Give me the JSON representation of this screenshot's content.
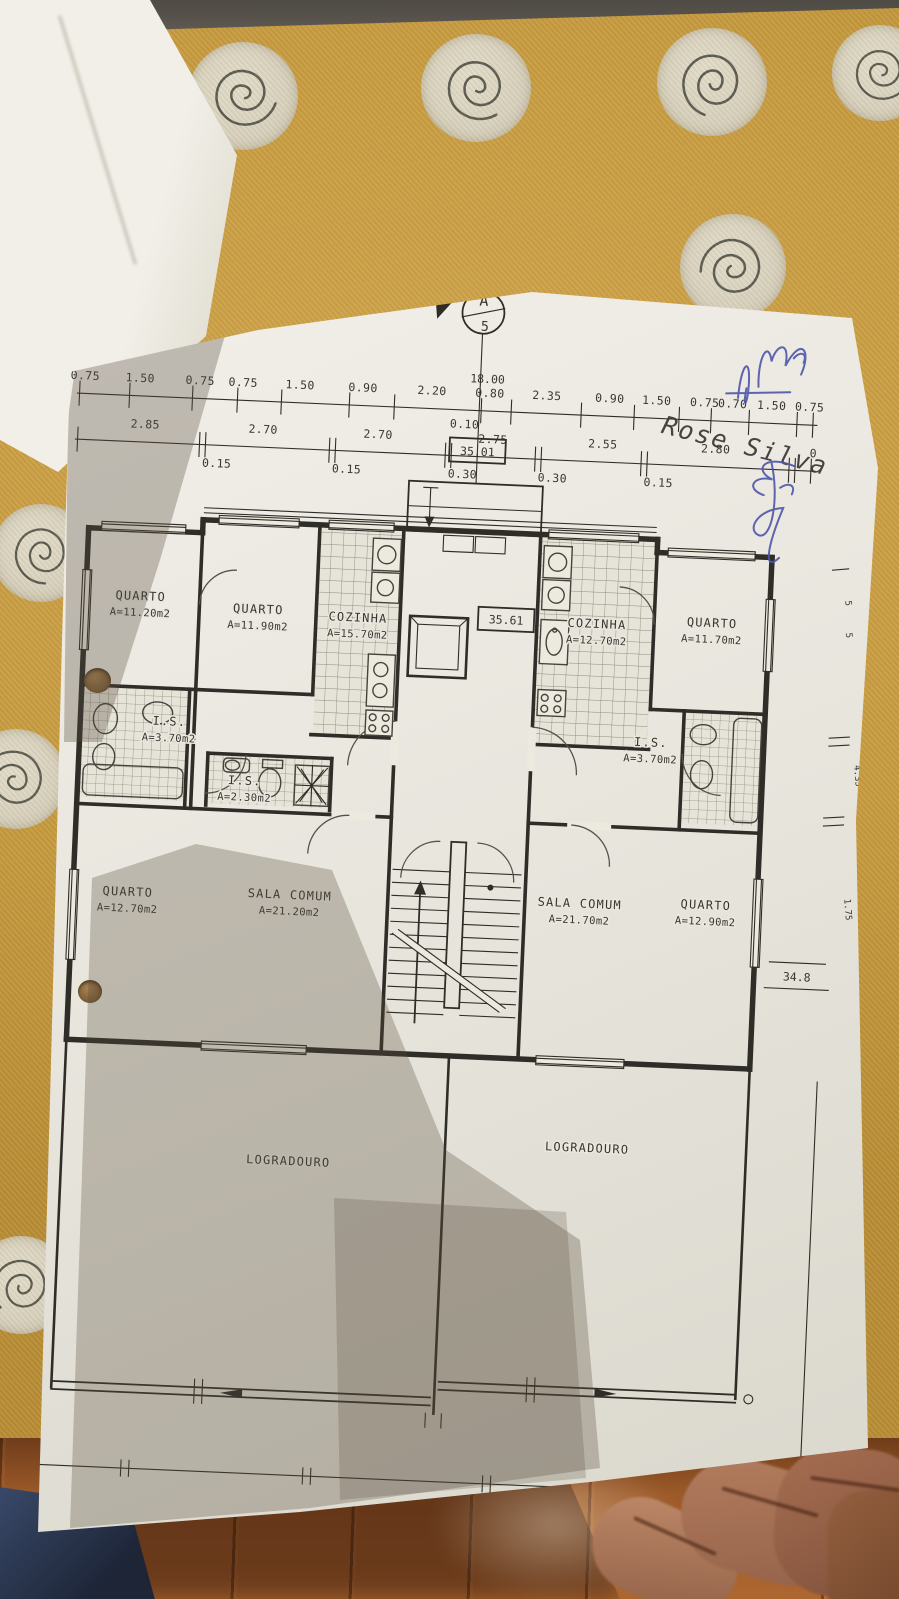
{
  "colors": {
    "cloth": "#c79b3f",
    "paper": "#e9e7df",
    "ink": "#2f2d28",
    "pen_blue": "#4d55a8",
    "wood": "#9c5a28"
  },
  "plan": {
    "section_marker": {
      "letter": "A",
      "number": "5"
    },
    "boxes": {
      "top": "35.01",
      "lobby": "35.61",
      "right_level": "34.8"
    },
    "dims": {
      "total": "18.00",
      "row1": [
        "0.75",
        "1.50",
        "0.75",
        "0.75",
        "1.50",
        "0.90",
        "2.20",
        "0.80",
        "2.35",
        "0.90",
        "1.50",
        "0.75",
        "0.70",
        "1.50",
        "0.75"
      ],
      "row2": [
        "2.85",
        "2.70",
        "2.70",
        "2.75",
        "2.55",
        "2.80",
        "0"
      ],
      "row3": [
        "0.15",
        "0.15",
        "0.10",
        "0.30",
        "0.30",
        "0.15"
      ],
      "margin_right": [
        "5",
        "5",
        "4.35",
        "1.75"
      ]
    },
    "rooms": [
      {
        "name": "QUARTO",
        "area": "A=11.20m2"
      },
      {
        "name": "QUARTO",
        "area": "A=11.90m2"
      },
      {
        "name": "COZINHA",
        "area": "A=15.70m2"
      },
      {
        "name": "COZINHA",
        "area": "A=12.70m2"
      },
      {
        "name": "QUARTO",
        "area": "A=11.70m2"
      },
      {
        "name": "I.S.",
        "area": "A=3.70m2"
      },
      {
        "name": "I.S.",
        "area": "A=2.30m2"
      },
      {
        "name": "I.S.",
        "area": "A=3.70m2"
      },
      {
        "name": "QUARTO",
        "area": "A=12.70m2"
      },
      {
        "name": "SALA COMUM",
        "area": "A=21.20m2"
      },
      {
        "name": "SALA COMUM",
        "area": "A=21.70m2"
      },
      {
        "name": "QUARTO",
        "area": "A=12.90m2"
      },
      {
        "name": "LOGRADOURO",
        "area": ""
      },
      {
        "name": "LOGRADOURO",
        "area": ""
      }
    ],
    "handwriting": {
      "signature": "Rose Silva"
    }
  }
}
